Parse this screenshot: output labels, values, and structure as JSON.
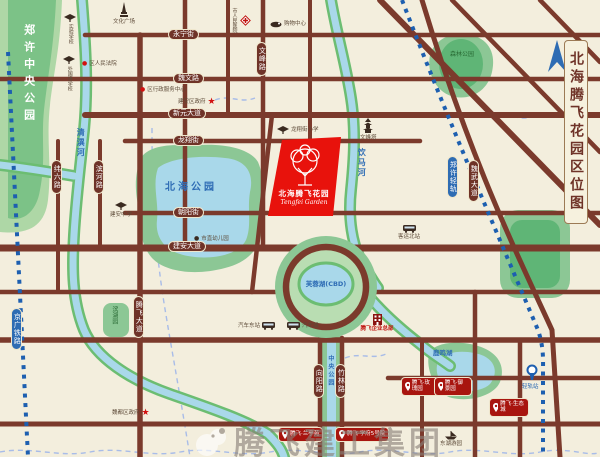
{
  "title": "北海腾飞花园区位图",
  "watermark": "腾飞建工集团",
  "project": {
    "name": "北海腾飞花园",
    "tagline": "Tengfei Garden"
  },
  "parks": {
    "central": "郑许中央公园",
    "beihai": "北海公园",
    "forest": "森林公园",
    "linear": "中央公园",
    "lakeside": "滨湖园"
  },
  "waters": {
    "qingyi": "清潩河",
    "yinma": "饮马河",
    "furong": "芙蓉湖(CBD)",
    "luming": "鹿鸣湖"
  },
  "roads": {
    "yongning": "永宁街",
    "weiwen": "魏文路",
    "xinyuan": "新元大道",
    "longxiang": "龙翔街",
    "chaoyang": "朝阳街",
    "jianan": "建安大道",
    "weiliu": "纬六路",
    "binhe": "滨河路",
    "wenfeng": "文峰路",
    "tengfei": "腾飞大道",
    "xiangyang": "向阳路",
    "zhulin": "竹林路",
    "weiwu": "魏武大道"
  },
  "railways": {
    "jingguang": "京广铁路",
    "zhengxu": "郑许轻轨",
    "station": "轻轨站"
  },
  "pois": [
    {
      "label": "文化广场"
    },
    {
      "label": "市人民医院"
    },
    {
      "label": "购物中心"
    },
    {
      "label": "龙翔街小学"
    },
    {
      "label": "文峰塔"
    },
    {
      "label": "建安中学"
    },
    {
      "label": "区人民法院"
    },
    {
      "label": "区行政服务中心"
    },
    {
      "label": "建安区政府"
    },
    {
      "label": "魏都区政府"
    },
    {
      "label": "汽车东站"
    },
    {
      "label": "汽车城"
    },
    {
      "label": "腾飞企业总部"
    },
    {
      "label": "市直幼儿园"
    },
    {
      "label": "客运北站"
    },
    {
      "label": "实验学校"
    },
    {
      "label": "外国语学校"
    },
    {
      "label": "东湖游园"
    }
  ],
  "badges": [
    {
      "label": "腾飞·玫瑰园"
    },
    {
      "label": "腾飞·御景园"
    },
    {
      "label": "腾飞·生态城"
    },
    {
      "label": "腾飞·兰亭苑"
    },
    {
      "label": "腾飞·学府5号院"
    }
  ],
  "colors": {
    "bg": "#f3eedd",
    "road": "#7b3a2c",
    "water": "#a9d8ea",
    "park": "#8cc795",
    "site_red": "#e8120c",
    "badge_red": "#a8150f",
    "rail_blue": "#2e6cb3",
    "label_blue": "#2f6db5"
  }
}
